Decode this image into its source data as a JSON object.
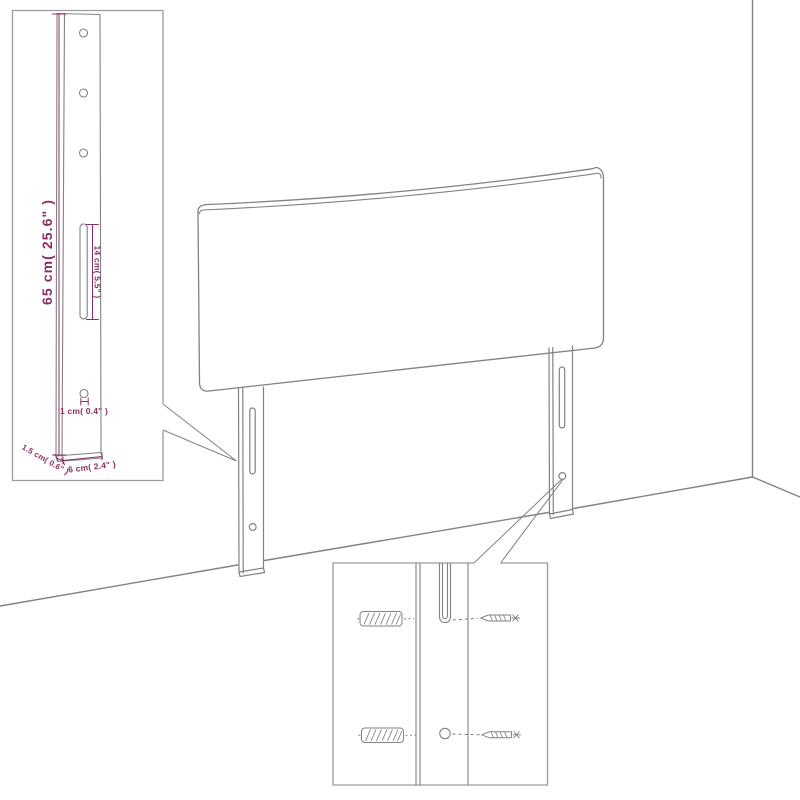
{
  "diagram": {
    "title": "Headboard wall-mounting assembly diagram",
    "colors": {
      "line": "#828282",
      "inset_border": "#9c9c9c",
      "dimension": "#8b2f63",
      "background": "#ffffff"
    },
    "leg_dimension_inset": {
      "labels": {
        "leg_height": "65 cm( 25.6\" )",
        "slot_length": "14 cm( 5.5\" )",
        "hole_diameter": "1 cm( 0.4\" )",
        "leg_thickness": "1.5 cm( 0.6\" )",
        "leg_width": "6 cm( 2.4\" )"
      }
    },
    "mounting_inset": {
      "hardware": {
        "anchor": "wall-plug",
        "fastener": "screw"
      }
    }
  }
}
